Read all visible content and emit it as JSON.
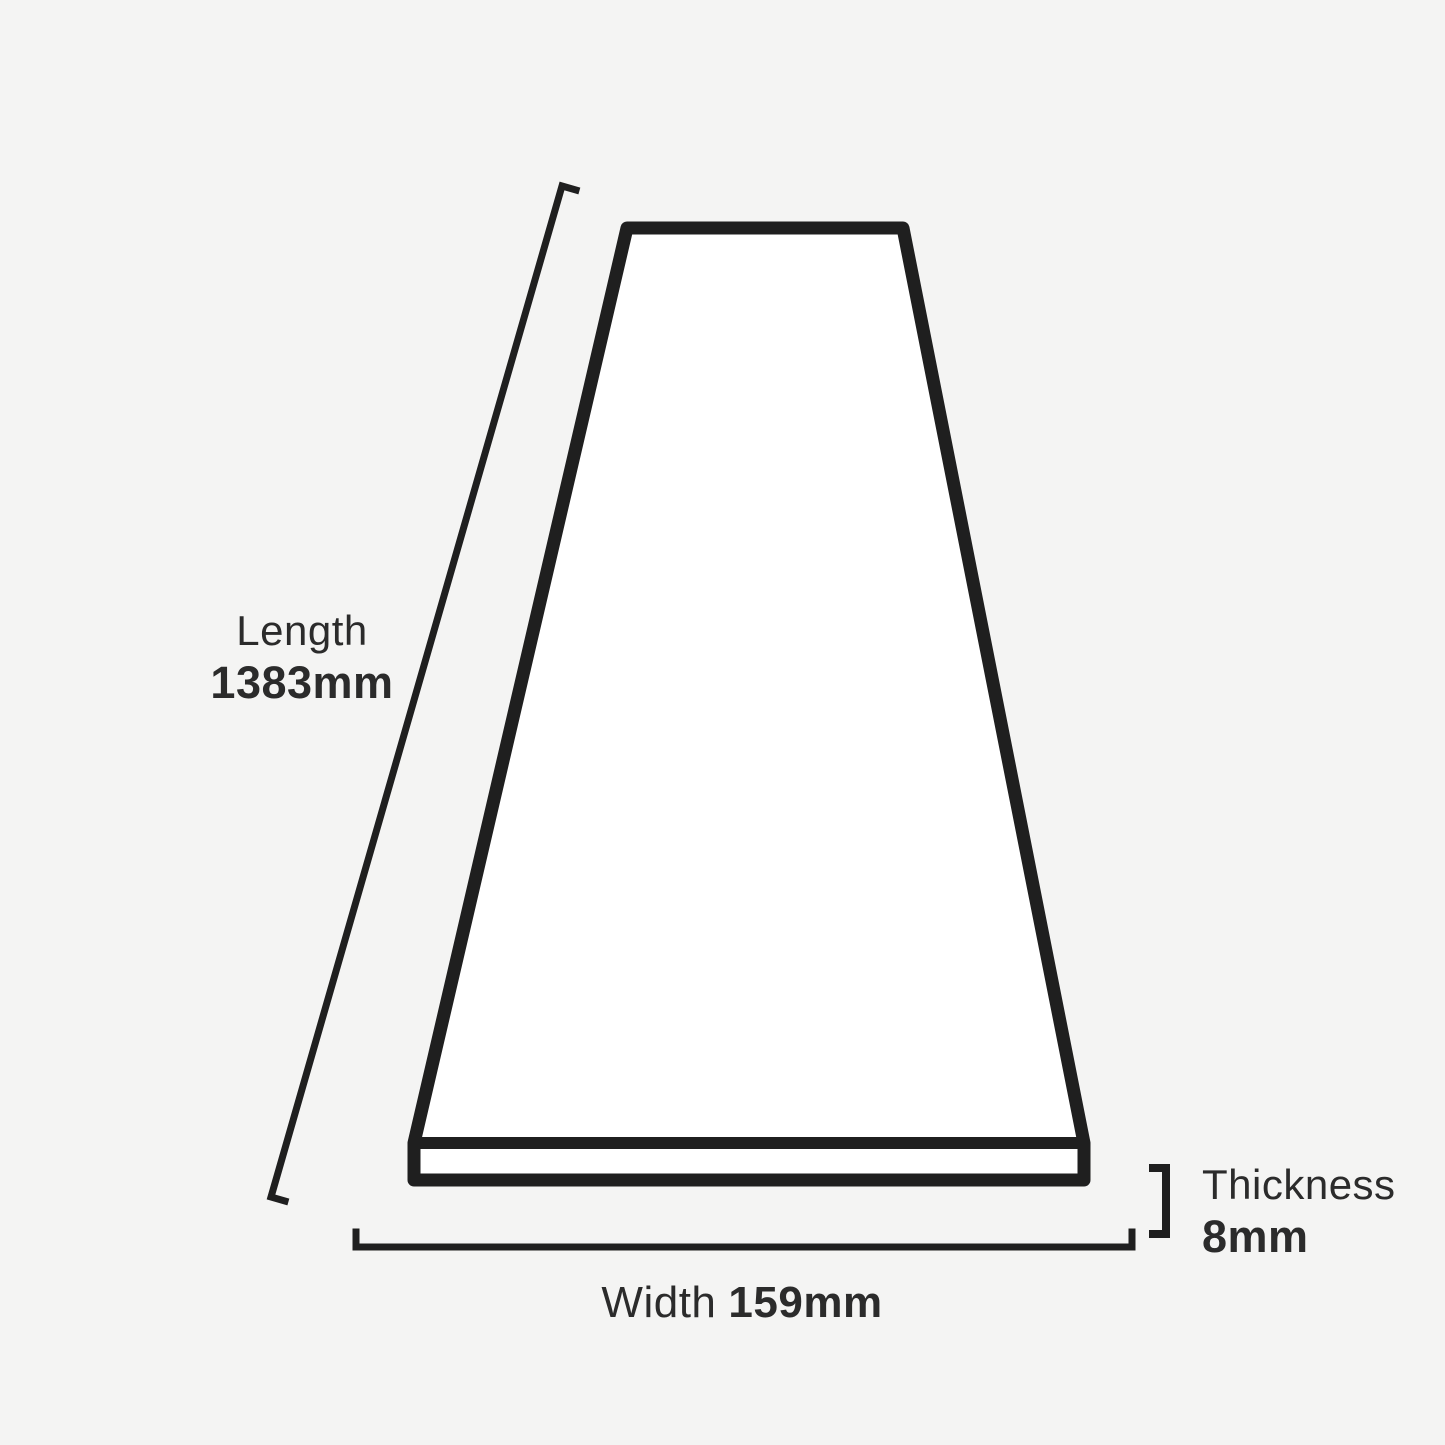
{
  "colors": {
    "background": "#f4f4f3",
    "line": "#1f1f1f",
    "text": "#2b2b2b",
    "plank_fill": "#ffffff"
  },
  "labels": {
    "length": {
      "title": "Length",
      "value": "1383mm"
    },
    "width": {
      "title": "Width",
      "value": "159mm"
    },
    "thickness": {
      "title": "Thickness",
      "value": "8mm"
    }
  }
}
